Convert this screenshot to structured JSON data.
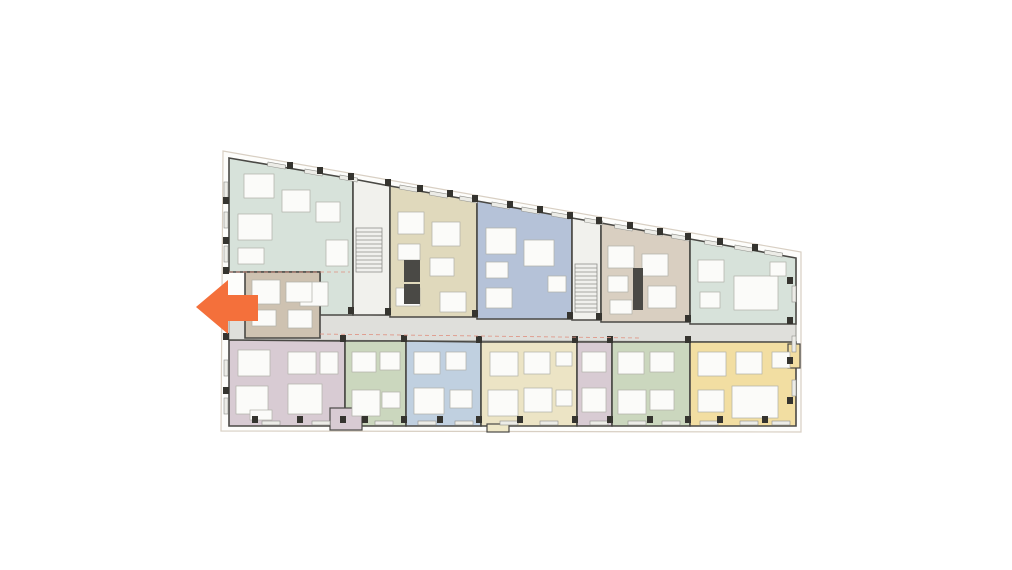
{
  "page": {
    "background": "#ffffff",
    "width": 1012,
    "height": 570
  },
  "arrow": {
    "label": "direction-arrow-left",
    "color": "#F4703B",
    "direction": "left",
    "points": [
      [
        196,
        307
      ],
      [
        228,
        280
      ],
      [
        228,
        295
      ],
      [
        258,
        295
      ],
      [
        258,
        321
      ],
      [
        228,
        321
      ],
      [
        228,
        334
      ]
    ]
  },
  "floorplan": {
    "wall_color": "#4A4945",
    "property_line": {
      "stroke": "#D8CFC3",
      "fill": "#FDFDFB",
      "points": [
        [
          223,
          151
        ],
        [
          801,
          252
        ],
        [
          801,
          432
        ],
        [
          221,
          431
        ]
      ]
    },
    "corridor": {
      "fill": "#DFDFDB",
      "stroke": "#8F8F8A",
      "points": [
        [
          229,
          312
        ],
        [
          796,
          324
        ],
        [
          796,
          342
        ],
        [
          229,
          340
        ]
      ]
    },
    "units": [
      {
        "id": "unit-mint-left",
        "fill": "#D7E2DA",
        "points": [
          [
            229,
            158
          ],
          [
            353,
            179
          ],
          [
            353,
            315
          ],
          [
            320,
            315
          ],
          [
            320,
            272
          ],
          [
            229,
            272
          ]
        ]
      },
      {
        "id": "core-stair-a",
        "fill": "#F1F1ED",
        "points": [
          [
            353,
            179
          ],
          [
            390,
            186
          ],
          [
            390,
            315
          ],
          [
            353,
            315
          ]
        ]
      },
      {
        "id": "unit-beige-top",
        "fill": "#E0D9BC",
        "points": [
          [
            390,
            186
          ],
          [
            477,
            201
          ],
          [
            477,
            317
          ],
          [
            390,
            317
          ]
        ]
      },
      {
        "id": "unit-blue-top",
        "fill": "#B5C2D8",
        "points": [
          [
            477,
            201
          ],
          [
            572,
            218
          ],
          [
            572,
            319
          ],
          [
            477,
            319
          ]
        ]
      },
      {
        "id": "core-stair-b",
        "fill": "#F1F1ED",
        "points": [
          [
            572,
            218
          ],
          [
            601,
            223
          ],
          [
            601,
            320
          ],
          [
            572,
            320
          ]
        ]
      },
      {
        "id": "unit-taupe-top",
        "fill": "#D9CFC1",
        "points": [
          [
            601,
            223
          ],
          [
            690,
            239
          ],
          [
            690,
            322
          ],
          [
            601,
            322
          ]
        ]
      },
      {
        "id": "unit-mint-right",
        "fill": "#D7E2DA",
        "points": [
          [
            690,
            239
          ],
          [
            796,
            258
          ],
          [
            796,
            324
          ],
          [
            690,
            324
          ]
        ]
      },
      {
        "id": "unit-tan-mid",
        "fill": "#CEC2B1",
        "points": [
          [
            245,
            272
          ],
          [
            320,
            272
          ],
          [
            320,
            338
          ],
          [
            245,
            338
          ]
        ]
      },
      {
        "id": "unit-mauve-1",
        "fill": "#D8CBD3",
        "points": [
          [
            229,
            340
          ],
          [
            345,
            341
          ],
          [
            345,
            426
          ],
          [
            229,
            426
          ]
        ]
      },
      {
        "id": "unit-green-1",
        "fill": "#CBD7BE",
        "points": [
          [
            345,
            341
          ],
          [
            406,
            341
          ],
          [
            406,
            426
          ],
          [
            345,
            426
          ]
        ]
      },
      {
        "id": "unit-blue-bottom",
        "fill": "#C0D0E0",
        "points": [
          [
            406,
            341
          ],
          [
            481,
            342
          ],
          [
            481,
            426
          ],
          [
            406,
            426
          ]
        ]
      },
      {
        "id": "unit-cream",
        "fill": "#ECE4C5",
        "points": [
          [
            481,
            342
          ],
          [
            577,
            342
          ],
          [
            577,
            426
          ],
          [
            481,
            426
          ]
        ]
      },
      {
        "id": "unit-mauve-2",
        "fill": "#D8CBD3",
        "points": [
          [
            577,
            342
          ],
          [
            612,
            342
          ],
          [
            612,
            426
          ],
          [
            577,
            426
          ]
        ]
      },
      {
        "id": "unit-green-2",
        "fill": "#CBD7BE",
        "points": [
          [
            612,
            342
          ],
          [
            690,
            342
          ],
          [
            690,
            426
          ],
          [
            612,
            426
          ]
        ]
      },
      {
        "id": "unit-yellow",
        "fill": "#F2DEA2",
        "points": [
          [
            690,
            342
          ],
          [
            796,
            342
          ],
          [
            796,
            426
          ],
          [
            690,
            426
          ]
        ]
      }
    ],
    "bays": [
      {
        "fill": "#D8CBD3",
        "x": 330,
        "y": 408,
        "w": 32,
        "h": 22
      },
      {
        "fill": "#EFE8C8",
        "x": 487,
        "y": 424,
        "w": 22,
        "h": 8
      },
      {
        "fill": "#F2DEA2",
        "x": 788,
        "y": 344,
        "w": 12,
        "h": 24
      }
    ],
    "rooms": {
      "fill": "#FBFBF9",
      "stroke": "#B0B0A8",
      "rects": [
        [
          244,
          174,
          30,
          24
        ],
        [
          282,
          190,
          28,
          22
        ],
        [
          316,
          202,
          24,
          20
        ],
        [
          238,
          214,
          34,
          26
        ],
        [
          238,
          248,
          26,
          16
        ],
        [
          300,
          282,
          28,
          24
        ],
        [
          326,
          240,
          22,
          26
        ],
        [
          398,
          212,
          26,
          22
        ],
        [
          432,
          222,
          28,
          24
        ],
        [
          398,
          244,
          22,
          16
        ],
        [
          430,
          258,
          24,
          18
        ],
        [
          440,
          292,
          26,
          20
        ],
        [
          396,
          288,
          24,
          18
        ],
        [
          486,
          228,
          30,
          26
        ],
        [
          524,
          240,
          30,
          26
        ],
        [
          486,
          262,
          22,
          16
        ],
        [
          548,
          276,
          18,
          16
        ],
        [
          486,
          288,
          26,
          20
        ],
        [
          608,
          246,
          26,
          22
        ],
        [
          642,
          254,
          26,
          22
        ],
        [
          608,
          276,
          20,
          16
        ],
        [
          648,
          286,
          28,
          22
        ],
        [
          610,
          300,
          22,
          14
        ],
        [
          698,
          260,
          26,
          22
        ],
        [
          700,
          292,
          20,
          16
        ],
        [
          734,
          276,
          44,
          34
        ],
        [
          770,
          262,
          16,
          14
        ],
        [
          252,
          280,
          28,
          24
        ],
        [
          286,
          282,
          26,
          20
        ],
        [
          252,
          310,
          24,
          16
        ],
        [
          288,
          310,
          24,
          18
        ],
        [
          238,
          350,
          32,
          26
        ],
        [
          288,
          352,
          28,
          22
        ],
        [
          236,
          386,
          32,
          28
        ],
        [
          288,
          384,
          34,
          30
        ],
        [
          320,
          352,
          18,
          22
        ],
        [
          250,
          410,
          22,
          10
        ],
        [
          352,
          352,
          24,
          20
        ],
        [
          380,
          352,
          20,
          18
        ],
        [
          352,
          390,
          28,
          26
        ],
        [
          382,
          392,
          18,
          16
        ],
        [
          414,
          352,
          26,
          22
        ],
        [
          446,
          352,
          20,
          18
        ],
        [
          414,
          388,
          30,
          26
        ],
        [
          450,
          390,
          22,
          18
        ],
        [
          490,
          352,
          28,
          24
        ],
        [
          524,
          352,
          26,
          22
        ],
        [
          488,
          390,
          30,
          26
        ],
        [
          524,
          388,
          28,
          24
        ],
        [
          556,
          352,
          16,
          14
        ],
        [
          556,
          390,
          16,
          16
        ],
        [
          582,
          352,
          24,
          20
        ],
        [
          582,
          388,
          24,
          24
        ],
        [
          618,
          352,
          26,
          22
        ],
        [
          650,
          352,
          24,
          20
        ],
        [
          618,
          390,
          28,
          24
        ],
        [
          650,
          390,
          24,
          20
        ],
        [
          698,
          352,
          28,
          24
        ],
        [
          736,
          352,
          26,
          22
        ],
        [
          698,
          390,
          26,
          22
        ],
        [
          732,
          386,
          46,
          32
        ],
        [
          772,
          352,
          18,
          16
        ]
      ]
    },
    "stairs": {
      "fill": "#F0F0ED",
      "tread": "#8F8F8A",
      "step": 4,
      "rects": [
        [
          356,
          228,
          26,
          44
        ],
        [
          575,
          264,
          22,
          48
        ]
      ]
    },
    "elevators": {
      "fill": "#4A4945",
      "rects": [
        [
          404,
          260,
          16,
          22
        ],
        [
          404,
          284,
          16,
          20
        ],
        [
          633,
          268,
          10,
          42
        ]
      ]
    },
    "columns": {
      "size": 6,
      "color": "#35342F",
      "points": [
        [
          290,
          165
        ],
        [
          320,
          170
        ],
        [
          351,
          176
        ],
        [
          388,
          182
        ],
        [
          420,
          188
        ],
        [
          450,
          193
        ],
        [
          475,
          198
        ],
        [
          510,
          204
        ],
        [
          540,
          209
        ],
        [
          570,
          215
        ],
        [
          599,
          220
        ],
        [
          630,
          225
        ],
        [
          660,
          231
        ],
        [
          688,
          236
        ],
        [
          720,
          241
        ],
        [
          755,
          247
        ],
        [
          351,
          310
        ],
        [
          388,
          311
        ],
        [
          475,
          313
        ],
        [
          570,
          315
        ],
        [
          599,
          316
        ],
        [
          688,
          318
        ],
        [
          343,
          338
        ],
        [
          404,
          338
        ],
        [
          479,
          339
        ],
        [
          575,
          339
        ],
        [
          610,
          339
        ],
        [
          688,
          339
        ],
        [
          255,
          419
        ],
        [
          300,
          419
        ],
        [
          343,
          419
        ],
        [
          365,
          419
        ],
        [
          404,
          419
        ],
        [
          440,
          419
        ],
        [
          479,
          419
        ],
        [
          520,
          419
        ],
        [
          575,
          419
        ],
        [
          610,
          419
        ],
        [
          650,
          419
        ],
        [
          688,
          419
        ],
        [
          720,
          419
        ],
        [
          765,
          419
        ],
        [
          226,
          200
        ],
        [
          226,
          240
        ],
        [
          226,
          270
        ],
        [
          226,
          336
        ],
        [
          226,
          390
        ],
        [
          790,
          280
        ],
        [
          790,
          320
        ],
        [
          790,
          360
        ],
        [
          790,
          400
        ]
      ]
    },
    "windows": {
      "fill": "#ECECE7",
      "stroke": "#90908B",
      "items": [
        [
          262,
          421,
          18,
          4,
          0
        ],
        [
          312,
          421,
          18,
          4,
          0
        ],
        [
          375,
          421,
          18,
          4,
          0
        ],
        [
          418,
          421,
          18,
          4,
          0
        ],
        [
          455,
          421,
          18,
          4,
          0
        ],
        [
          500,
          421,
          18,
          4,
          0
        ],
        [
          540,
          421,
          18,
          4,
          0
        ],
        [
          590,
          421,
          18,
          4,
          0
        ],
        [
          628,
          421,
          18,
          4,
          0
        ],
        [
          662,
          421,
          18,
          4,
          0
        ],
        [
          700,
          421,
          18,
          4,
          0
        ],
        [
          740,
          421,
          18,
          4,
          0
        ],
        [
          772,
          421,
          18,
          4,
          0
        ],
        [
          224,
          182,
          4,
          16,
          0
        ],
        [
          224,
          212,
          4,
          16,
          0
        ],
        [
          224,
          246,
          4,
          16,
          0
        ],
        [
          224,
          300,
          4,
          16,
          0
        ],
        [
          224,
          360,
          4,
          16,
          0
        ],
        [
          224,
          398,
          4,
          16,
          0
        ],
        [
          792,
          286,
          4,
          16,
          0
        ],
        [
          792,
          336,
          4,
          16,
          0
        ],
        [
          792,
          380,
          4,
          16,
          0
        ],
        [
          268,
          162,
          18,
          4,
          10
        ],
        [
          305,
          169,
          18,
          4,
          10
        ],
        [
          340,
          175,
          18,
          4,
          10
        ],
        [
          400,
          185,
          18,
          4,
          10
        ],
        [
          430,
          191,
          18,
          4,
          10
        ],
        [
          460,
          196,
          18,
          4,
          10
        ],
        [
          492,
          202,
          18,
          4,
          10
        ],
        [
          522,
          207,
          18,
          4,
          10
        ],
        [
          552,
          212,
          18,
          4,
          10
        ],
        [
          585,
          218,
          18,
          4,
          10
        ],
        [
          615,
          224,
          18,
          4,
          10
        ],
        [
          645,
          229,
          18,
          4,
          10
        ],
        [
          672,
          234,
          18,
          4,
          10
        ],
        [
          705,
          240,
          18,
          4,
          10
        ],
        [
          735,
          245,
          18,
          4,
          10
        ],
        [
          765,
          250,
          18,
          4,
          10
        ]
      ]
    },
    "dashed_lines": [
      {
        "x1": 229,
        "y1": 272,
        "x2": 350,
        "y2": 272,
        "color": "#DF9080"
      },
      {
        "x1": 320,
        "y1": 334,
        "x2": 640,
        "y2": 338,
        "color": "#DF9080"
      }
    ]
  }
}
